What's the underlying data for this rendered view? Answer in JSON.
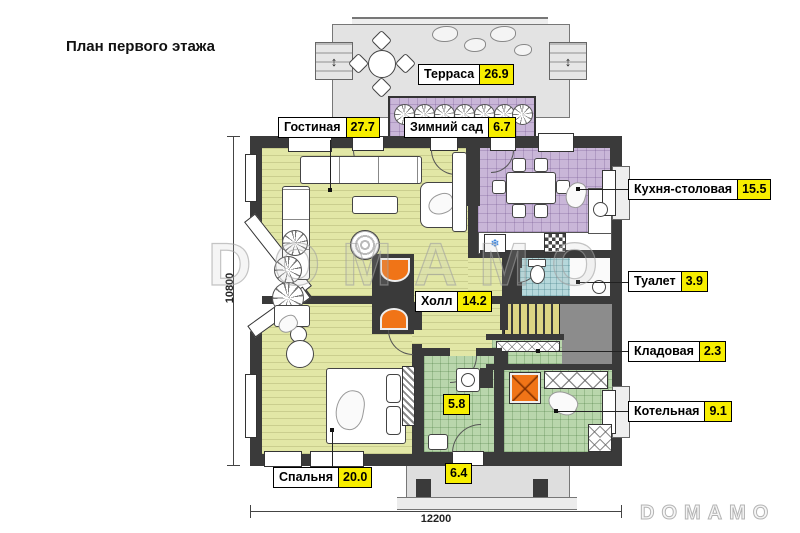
{
  "title": "План первого этажа",
  "watermark": {
    "center": "DOMAMO",
    "corner": "DOMAMO"
  },
  "dimensions": {
    "width_label": "12200",
    "height_label": "10800"
  },
  "icons": {
    "fridge": "❄",
    "stairs_updown": "↕",
    "dim_arrow": "↔"
  },
  "colors": {
    "walls": "#3a3a3a",
    "living_fill": "#e2e7a6",
    "kitchen_fill": "#c9b6d8",
    "boiler_fill": "#b9d6ac",
    "toilet_fill": "#b6d8db",
    "terrace_fill": "#e3e3e3",
    "area_badge": "#f7ee00",
    "fire_accent": "#f07417"
  },
  "rooms": [
    {
      "name": "Терраса",
      "area": "26.9"
    },
    {
      "name": "Гостиная",
      "area": "27.7"
    },
    {
      "name": "Зимний сад",
      "area": "6.7"
    },
    {
      "name": "Кухня-столовая",
      "area": "15.5"
    },
    {
      "name": "Туалет",
      "area": "3.9"
    },
    {
      "name": "Холл",
      "area": "14.2"
    },
    {
      "name": "Кладовая",
      "area": "2.3"
    },
    {
      "name": "Котельная",
      "area": "9.1"
    },
    {
      "name": "Спальня",
      "area": "20.0"
    },
    {
      "name": "",
      "area": "5.8"
    },
    {
      "name": "",
      "area": "6.4"
    }
  ]
}
